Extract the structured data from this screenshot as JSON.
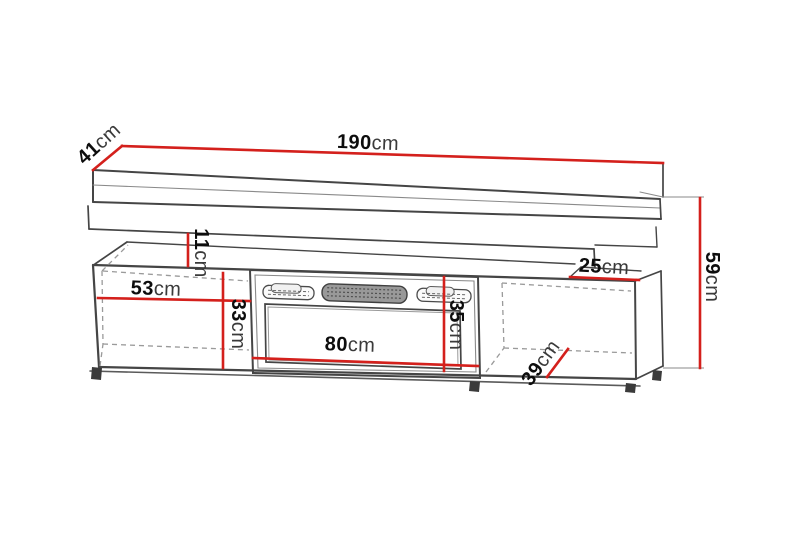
{
  "diagram": {
    "dimensions": {
      "total_width": {
        "value": "190",
        "unit": "cm"
      },
      "shelf_depth": {
        "value": "41",
        "unit": "cm"
      },
      "total_height": {
        "value": "59",
        "unit": "cm"
      },
      "shelf_gap_height": {
        "value": "11",
        "unit": "cm"
      },
      "right_top_depth": {
        "value": "25",
        "unit": "cm"
      },
      "left_cabinet_width": {
        "value": "53",
        "unit": "cm"
      },
      "cabinet_height": {
        "value": "33",
        "unit": "cm"
      },
      "fireplace_width": {
        "value": "80",
        "unit": "cm"
      },
      "fireplace_height": {
        "value": "35",
        "unit": "cm"
      },
      "cabinet_depth": {
        "value": "39",
        "unit": "cm"
      }
    },
    "colors": {
      "dimension_line": "#d4201c",
      "outline": "#454545",
      "hidden_line": "#9a9a9a",
      "label_text": "#0d0d0d",
      "background": "#ffffff"
    }
  }
}
